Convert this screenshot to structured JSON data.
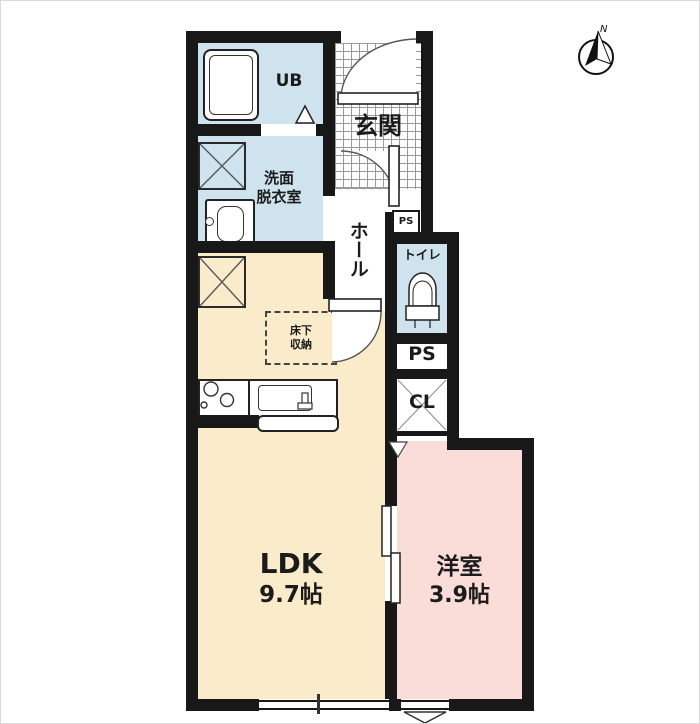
{
  "title": "1LDK apartment floor plan",
  "compass": {
    "label": "N"
  },
  "rooms": {
    "ub": {
      "label": "UB"
    },
    "entrance": {
      "label": "玄関"
    },
    "washroom": {
      "line1": "洗面",
      "line2": "脱衣室"
    },
    "hall": {
      "label": "ホール"
    },
    "toilet": {
      "label": "トイレ"
    },
    "pipe_space_upper": {
      "label": "PS"
    },
    "pipe_space": {
      "label": "PS"
    },
    "closet": {
      "label": "CL"
    },
    "ldk": {
      "name": "LDK",
      "size": "9.7帖"
    },
    "western_room": {
      "name": "洋室",
      "size": "3.9帖"
    }
  },
  "features": {
    "underfloor_storage": {
      "line1": "床下",
      "line2": "収納"
    }
  },
  "colors": {
    "wall": "#181818",
    "wet_area": "#cfe3ee",
    "ldk_floor": "#faecca",
    "western_room_floor": "#fadcd9",
    "background": "#ffffff"
  }
}
